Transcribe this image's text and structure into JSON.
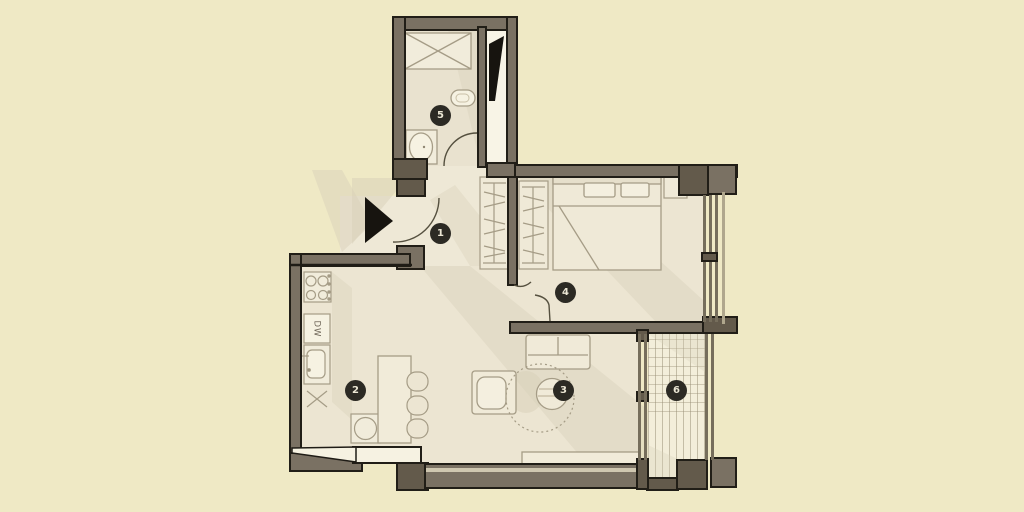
{
  "plan": {
    "type": "apartment-floor-plan",
    "colors": {
      "background": "#efe9c5",
      "floor": "#ece5d2",
      "balcony_floor": "#f3eeda",
      "wall": "#7a7163",
      "wall_dark": "#635a4b",
      "outline": "#211e17",
      "shadow": "#d8cfb8",
      "fixture_fill": "#f6f2e2",
      "label_background": "#2c2a24",
      "label_text": "#ebe6d4"
    },
    "icons": {
      "entry_arrow": "triangle-right"
    },
    "room_labels": [
      {
        "number": "1"
      },
      {
        "number": "2"
      },
      {
        "number": "3"
      },
      {
        "number": "4"
      },
      {
        "number": "5"
      },
      {
        "number": "6"
      }
    ],
    "appliances": {
      "dishwasher_label": "DW"
    }
  }
}
